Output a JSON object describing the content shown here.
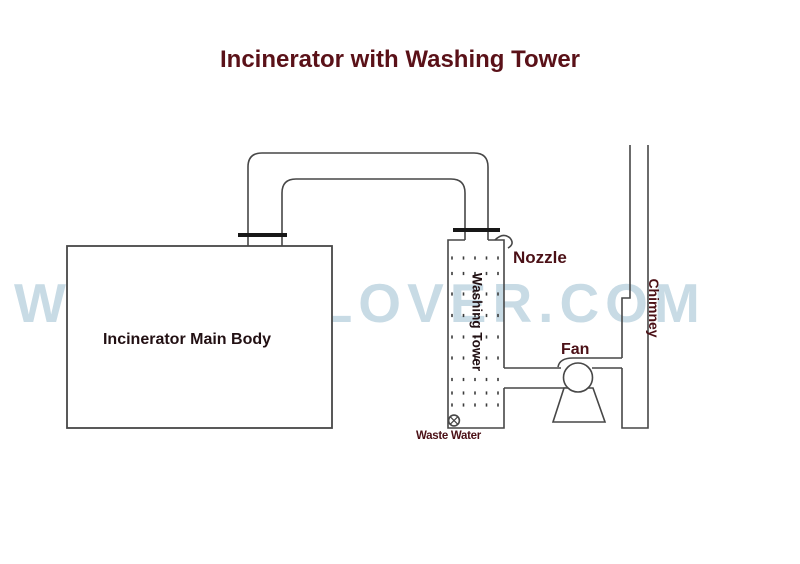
{
  "title": {
    "text": "Incinerator with Washing Tower"
  },
  "watermark": {
    "text": "WWW.HICLOVER.COM"
  },
  "diagram": {
    "incinerator_label": "Incinerator Main Body",
    "washing_tower_label": "Washing Tower",
    "nozzle_label": "Nozzle",
    "fan_label": "Fan",
    "waste_water_label": "Waste Water",
    "chimney_label": "Chimney"
  },
  "colors": {
    "title": "#5a1118",
    "label_maroon": "#4b1016",
    "label_dark": "#221013",
    "watermark": "#c8dbe5",
    "line": "#474747",
    "flange": "#181818"
  }
}
